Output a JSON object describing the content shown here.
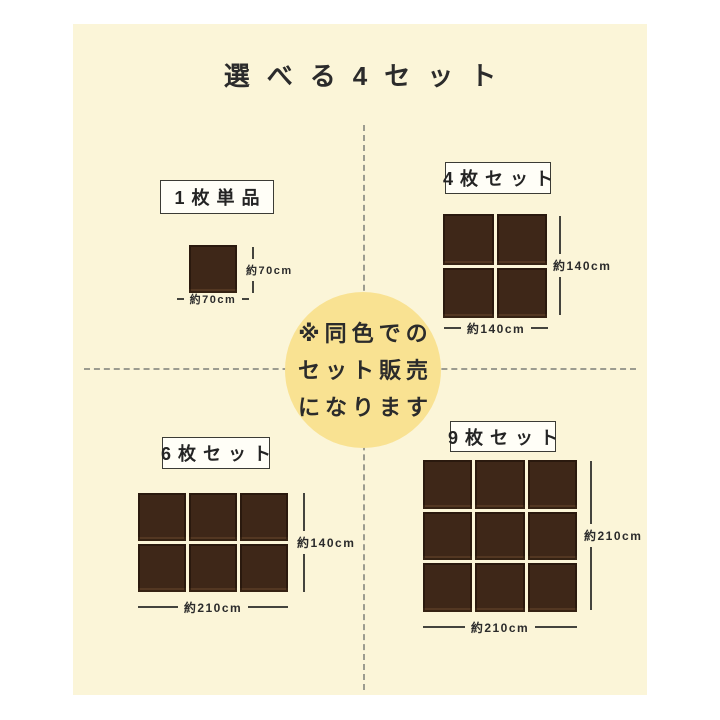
{
  "title": "選べる4セット",
  "note": {
    "lines": [
      "※同色での",
      "セット販売",
      "になります"
    ]
  },
  "sets": [
    {
      "id": "single",
      "label": "1枚単品",
      "grid": {
        "cols": 1,
        "rows": 1
      },
      "width_label": "約70cm",
      "height_label": "約70cm"
    },
    {
      "id": "set4",
      "label": "4枚セット",
      "grid": {
        "cols": 2,
        "rows": 2
      },
      "width_label": "約140cm",
      "height_label": "約140cm"
    },
    {
      "id": "set6",
      "label": "6枚セット",
      "grid": {
        "cols": 3,
        "rows": 2
      },
      "width_label": "約210cm",
      "height_label": "約140cm"
    },
    {
      "id": "set9",
      "label": "9枚セット",
      "grid": {
        "cols": 3,
        "rows": 3
      },
      "width_label": "約210cm",
      "height_label": "約210cm"
    }
  ],
  "colors": {
    "page_background": "#ffffff",
    "panel_background": "#fbf5d8",
    "circle_background": "#f9e292",
    "tile_brown": "#3e2718",
    "text": "#2b2b2b",
    "dimension_line": "#44443e",
    "dashed_divider": "#9c9c90",
    "label_box_background": "#fffef7",
    "label_box_border": "#3b3b35"
  }
}
